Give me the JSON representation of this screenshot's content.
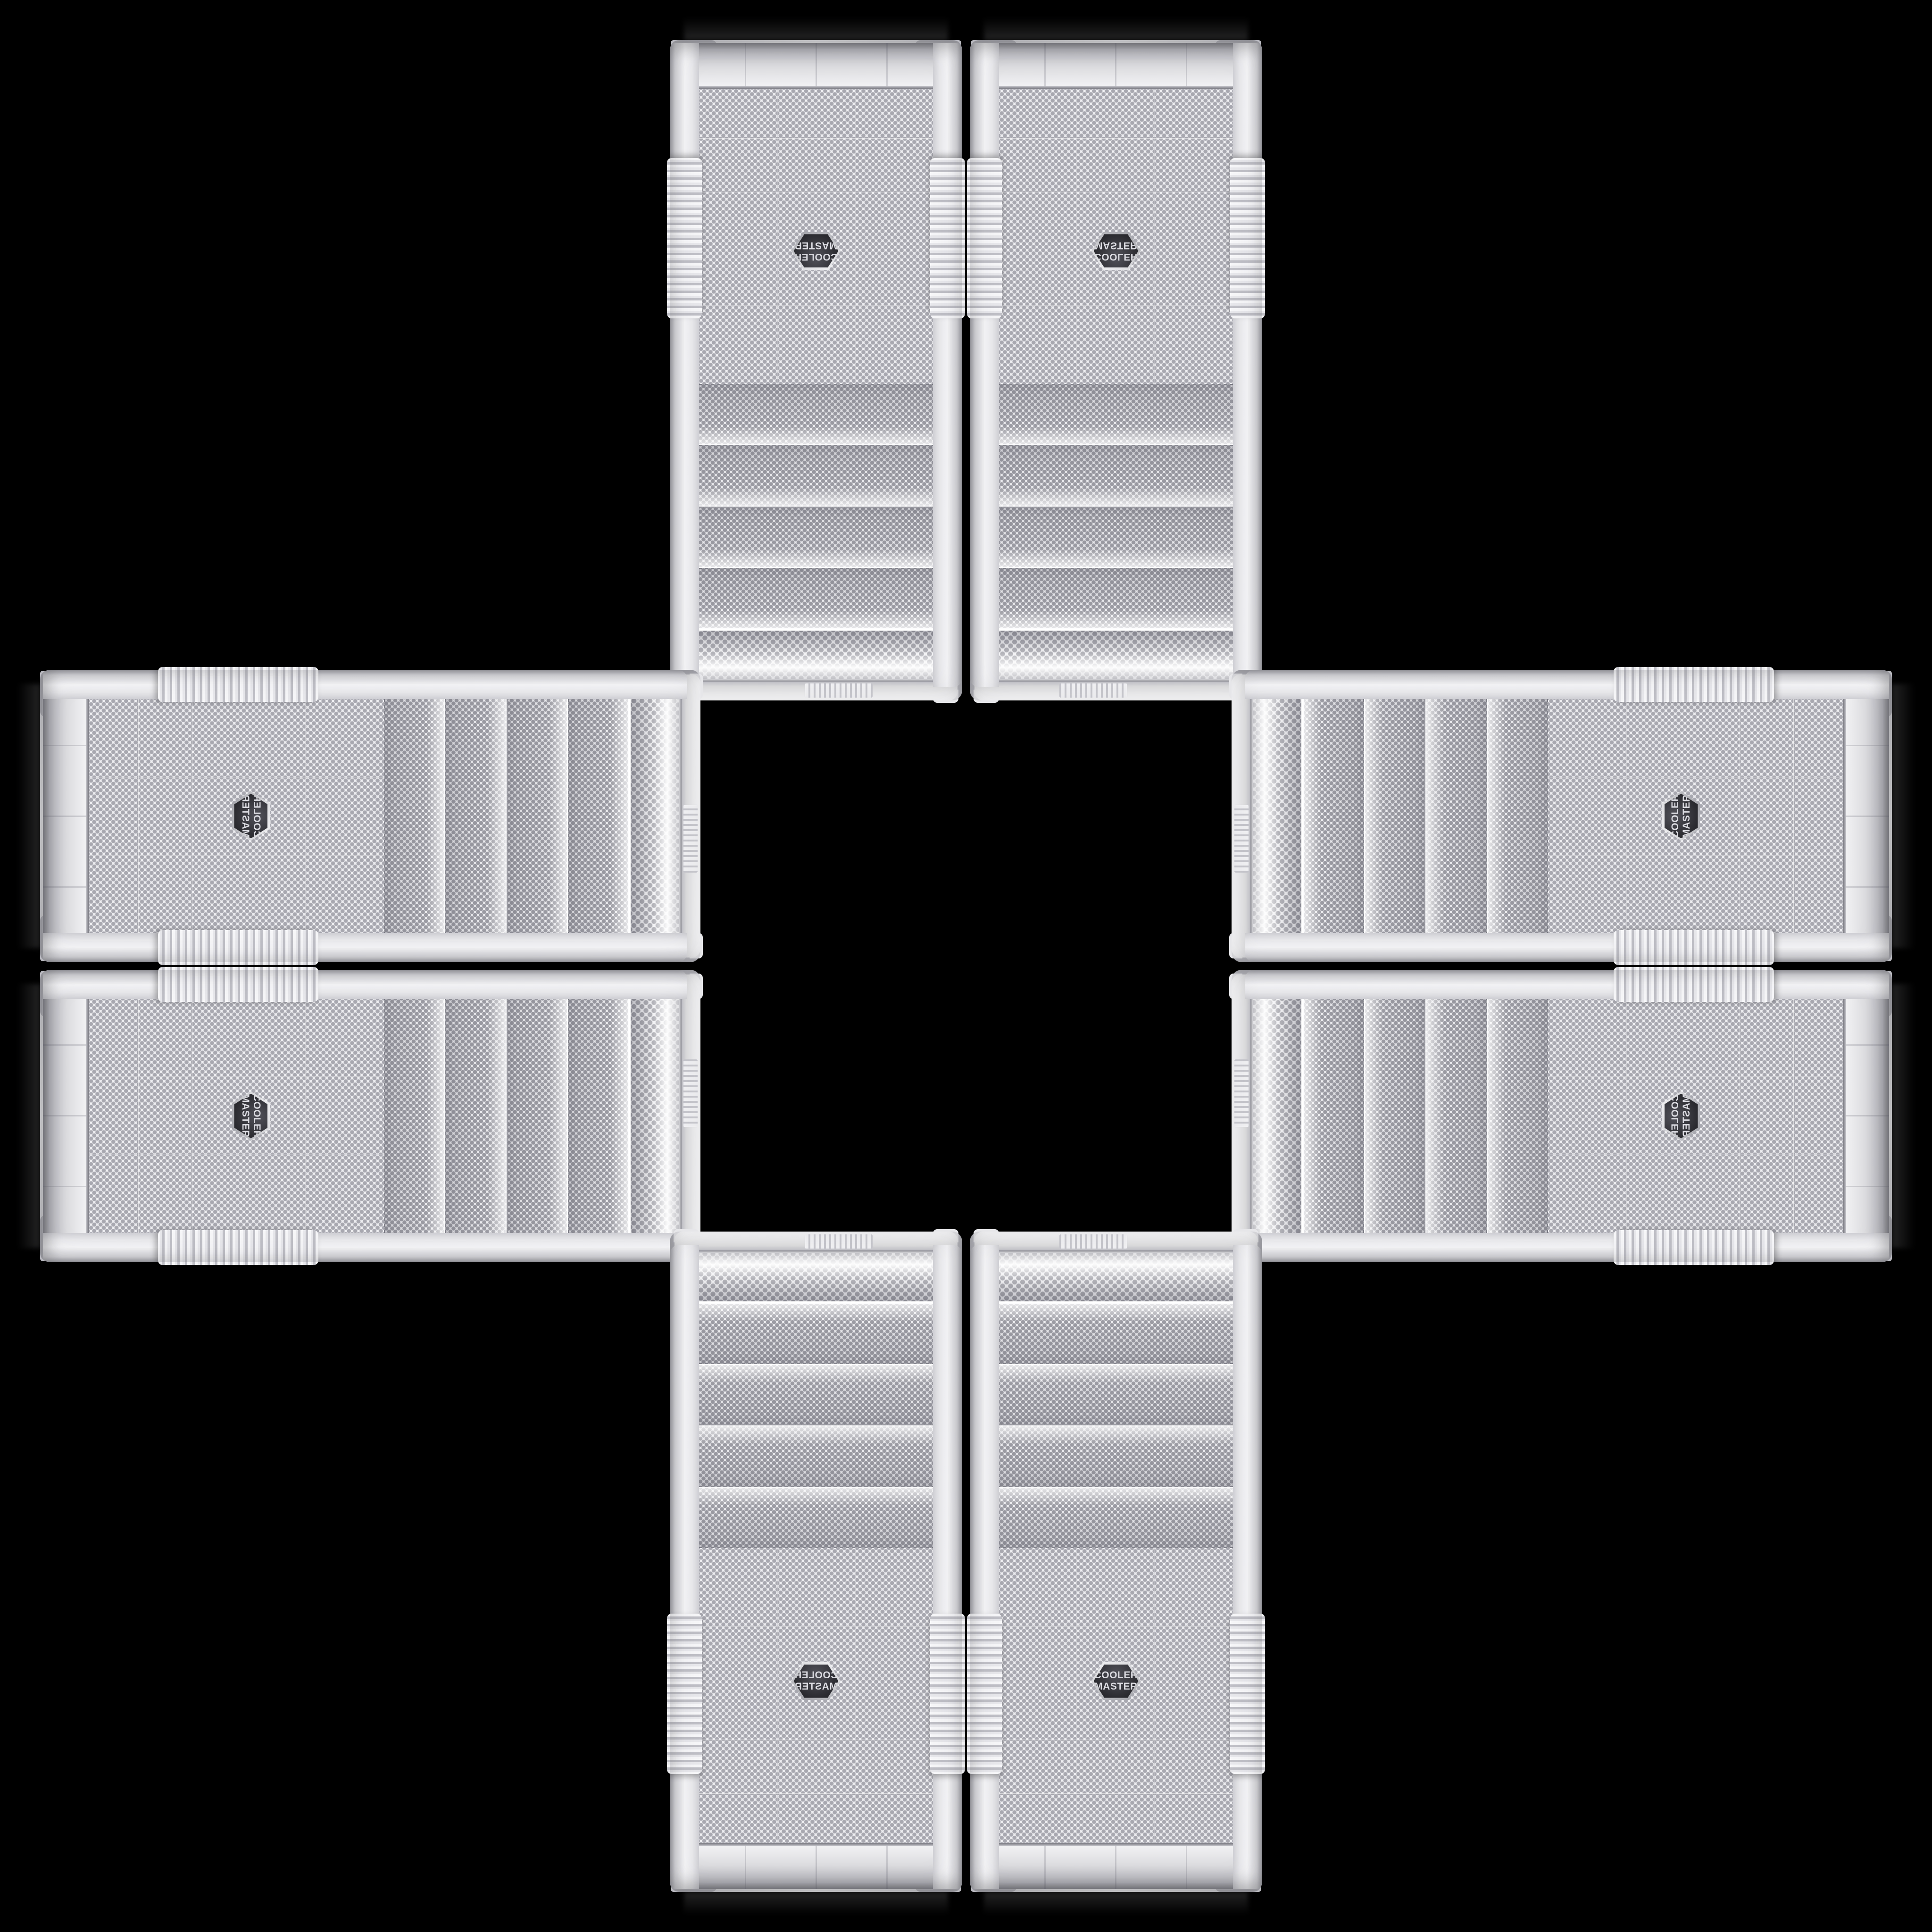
{
  "scene": {
    "type": "product-photo-collage",
    "description": "Eight identical white Cooler Master mesh-front PC tower cases arranged in a plus / cross pattern on a black background; each arm of the cross is a mirrored pair of the same case photo (rotated 90/180 degrees per arm)",
    "background_color": "#000000",
    "case_body_color": "#efeff2",
    "case_shadow_color": "#9d9da4",
    "mesh_dot_color": "#a0a0a8",
    "badge_background_color": "#2a2a2f",
    "badge_rim_color": "#c9c9cf",
    "badge_text_color": "#dcdce2",
    "case_count": 8
  },
  "badge": {
    "line1": "COOLER",
    "line2": "MASTER"
  },
  "cases": [
    {
      "id": "top-left",
      "slot": "top-left",
      "arm": "top",
      "orientation": "rotated 180°"
    },
    {
      "id": "top-right",
      "slot": "top-right",
      "arm": "top",
      "orientation": "flipped vertically"
    },
    {
      "id": "left-top",
      "slot": "left-top",
      "arm": "left",
      "orientation": "rotated 90° CCW, mirrored"
    },
    {
      "id": "right-top",
      "slot": "right-top",
      "arm": "right",
      "orientation": "rotated 90° CCW"
    },
    {
      "id": "left-bottom",
      "slot": "left-bottom",
      "arm": "left",
      "orientation": "rotated 90° CW"
    },
    {
      "id": "right-bottom",
      "slot": "right-bottom",
      "arm": "right",
      "orientation": "rotated 90° CCW, flipped vertically"
    },
    {
      "id": "bottom-left",
      "slot": "bottom-left",
      "arm": "bottom",
      "orientation": "mirrored horizontally"
    },
    {
      "id": "bottom-right",
      "slot": "bottom-right",
      "arm": "bottom",
      "orientation": "upright (source photo)"
    }
  ]
}
